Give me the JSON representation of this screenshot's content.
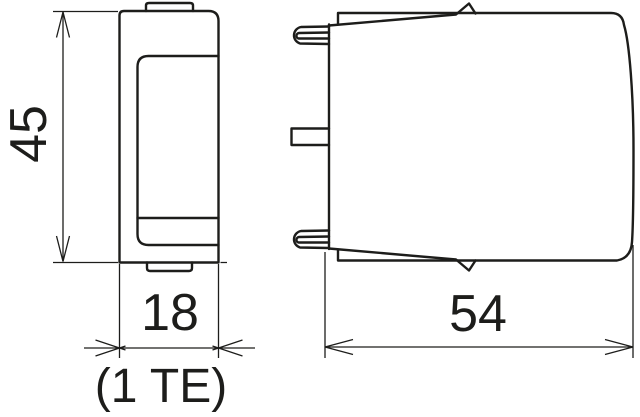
{
  "drawing": {
    "background_color": "#ffffff",
    "line_color": "#1d1d1b",
    "dimensions": {
      "height": "45",
      "width": "18",
      "width_unit": "(1 TE)",
      "depth": "54"
    }
  }
}
